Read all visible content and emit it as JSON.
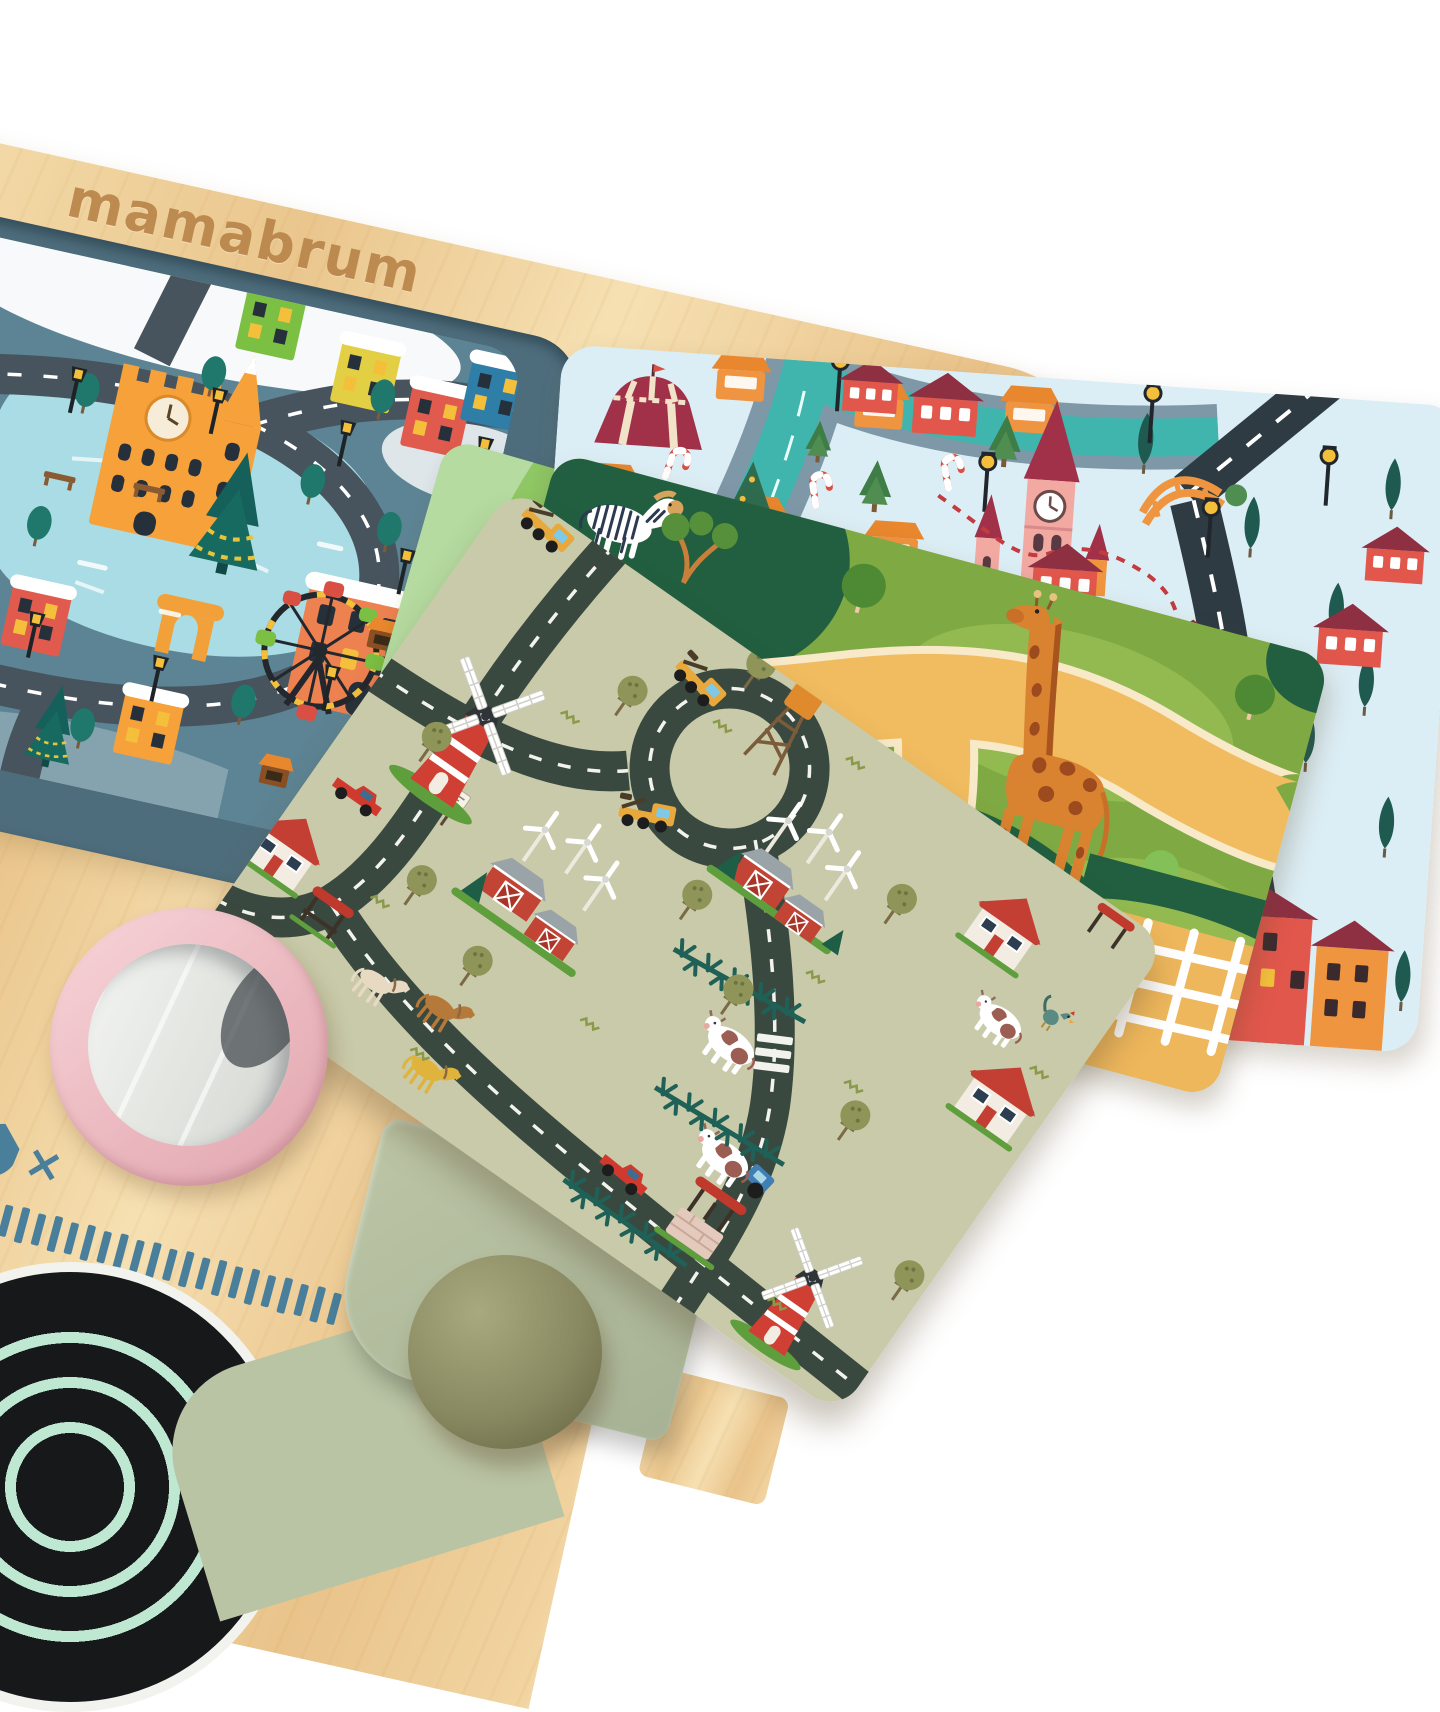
{
  "scene": {
    "type": "product-photograph",
    "subject": "Children's wooden play board with a stack of interchangeable double-sided road play mats",
    "background": "white"
  },
  "brand": {
    "logo_text": "mamabrum",
    "logo_color": "#b9854a"
  },
  "board": {
    "material": "birch plywood",
    "wood_light": "#f6e0b2",
    "wood_dark": "#e9c38a",
    "tray_color": "#4e6d7c"
  },
  "mats": [
    {
      "id": "winter-city",
      "placement": "printed inside recessed tray, top left",
      "bg": "#5d8494",
      "elements": [
        "orange castle with clock tower",
        "frozen pond",
        "ring road with white dashes",
        "christmas trees with garlands",
        "green yellow red and blue townhouses",
        "ferris wheel",
        "triumphal arch",
        "street lamps",
        "park benches",
        "market stalls",
        "snow patches"
      ]
    },
    {
      "id": "christmas-town",
      "placement": "top right, below board edge",
      "bg": "#dceef5",
      "elements": [
        "circus tent",
        "market stalls",
        "candy canes",
        "christmas tree",
        "teal river",
        "orange bridge",
        "pink clock tower",
        "church spires",
        "asphalt road with white dashes",
        "red dashed trail",
        "houses with maroon roofs",
        "cypress trees",
        "street lamps",
        "row houses"
      ]
    },
    {
      "id": "zoo",
      "placement": "middle, under the farm mat",
      "bg": "#7fa943",
      "elements": [
        "zebra",
        "hippo",
        "giraffe",
        "sandy visitor paths",
        "dark green enclosures",
        "trees",
        "white fence on sand"
      ]
    },
    {
      "id": "farm",
      "placement": "front, on top of the stack",
      "bg": "#c8caa9",
      "elements": [
        "red windmills",
        "red barns",
        "white wind turbines",
        "water tower",
        "loop road with white dashes",
        "yellow service trucks",
        "red pickup trucks",
        "blue tractor",
        "horses",
        "cows",
        "rooster",
        "pine-branch fences",
        "stone well",
        "bus shelter",
        "houses with red roofs",
        "zebra crossing",
        "road sign",
        "olive trees"
      ]
    },
    {
      "id": "river-meadow",
      "placement": "thin sliver under the zoo mat",
      "bg": "#8fc765",
      "elements": [
        "blue river",
        "mint meadow band"
      ]
    }
  ],
  "accessories": [
    {
      "id": "pink-mirror",
      "color": "#eab6bd"
    },
    {
      "id": "stove-burner",
      "color": "#17181a",
      "ring_color": "#bfe8d2"
    },
    {
      "id": "ruler-ticks",
      "color": "#4a7f9b",
      "count": 22
    },
    {
      "id": "multiplier-mark",
      "text": "×",
      "color": "#4a7f9b"
    },
    {
      "id": "wooden-knob",
      "color": "#8a8a62"
    },
    {
      "id": "sage-panel",
      "color": "#b4bfa0"
    }
  ]
}
